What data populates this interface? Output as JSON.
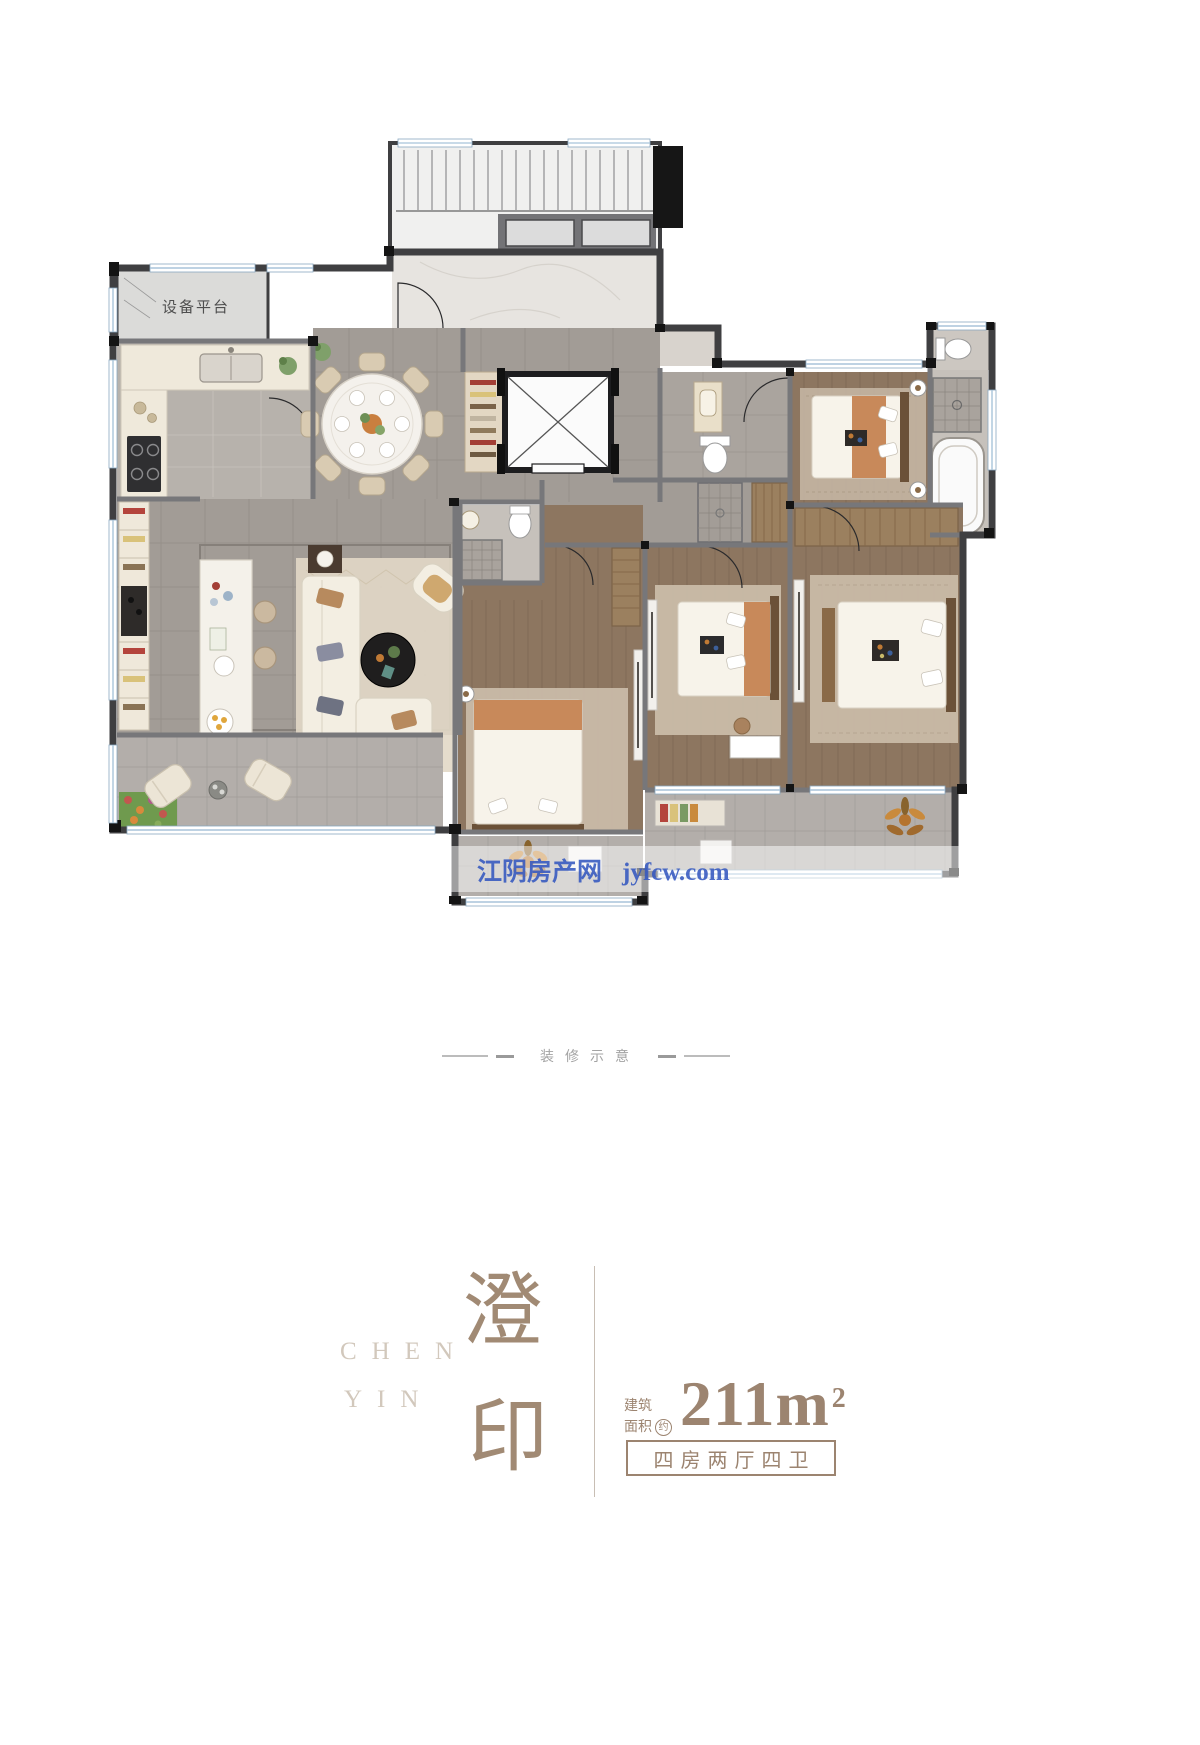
{
  "floor_plan": {
    "equipment_platform_label": "设备平台",
    "watermark": {
      "site_name": "江阴房产网",
      "site_url": "jyfcw.com"
    }
  },
  "decoration_note": {
    "label": "装修示意"
  },
  "brand": {
    "name_char_1": "澄",
    "name_char_2": "印",
    "name_latin_line1": "CHEN",
    "name_latin_line2": "YIN"
  },
  "spec": {
    "area_label_line1": "建筑",
    "area_label_line2": "面积",
    "area_approx_badge": "约",
    "area_value": "211m",
    "area_superscript": "2",
    "layout_tag": "四房两厅四卫"
  },
  "colors": {
    "accent_brown": "#9c8470",
    "watermark_blue": "#3558c0",
    "wall_dark": "#3f3f41"
  }
}
